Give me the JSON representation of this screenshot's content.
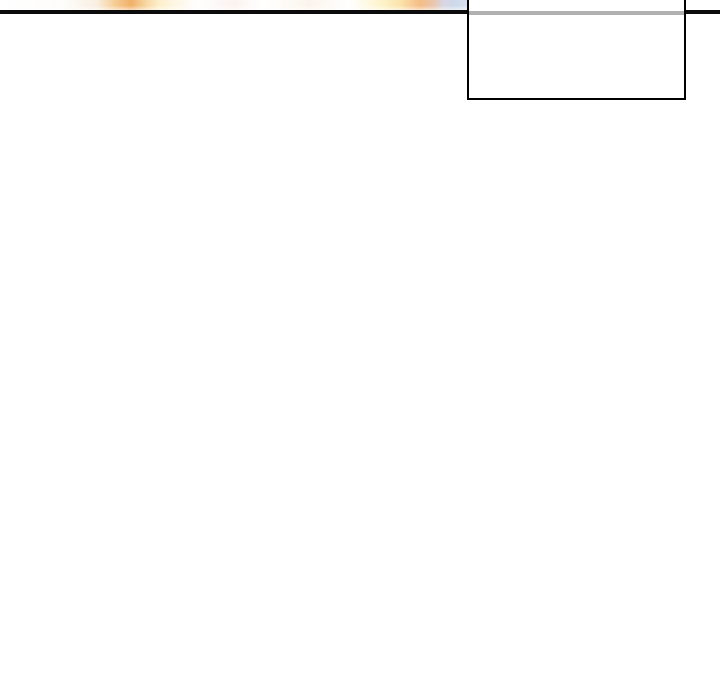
{
  "window": {
    "width": 720,
    "height": 700
  },
  "theme": {
    "page-bg": "#ffffff",
    "divider-color": "#0b0b0b",
    "dropdown-border-color": "#000000",
    "dropdown-bg": "#ffffff",
    "dropdown-separator-color": "#b0b0b0",
    "banner-glow-orange": "#f1b068",
    "banner-glow-cream": "#fdf0cc",
    "banner-glow-yellow": "#fbe3ac",
    "banner-glow-orange-2": "#f4bd85",
    "banner-glow-blue": "#ccd8ea"
  },
  "dropdown": {
    "items": []
  }
}
